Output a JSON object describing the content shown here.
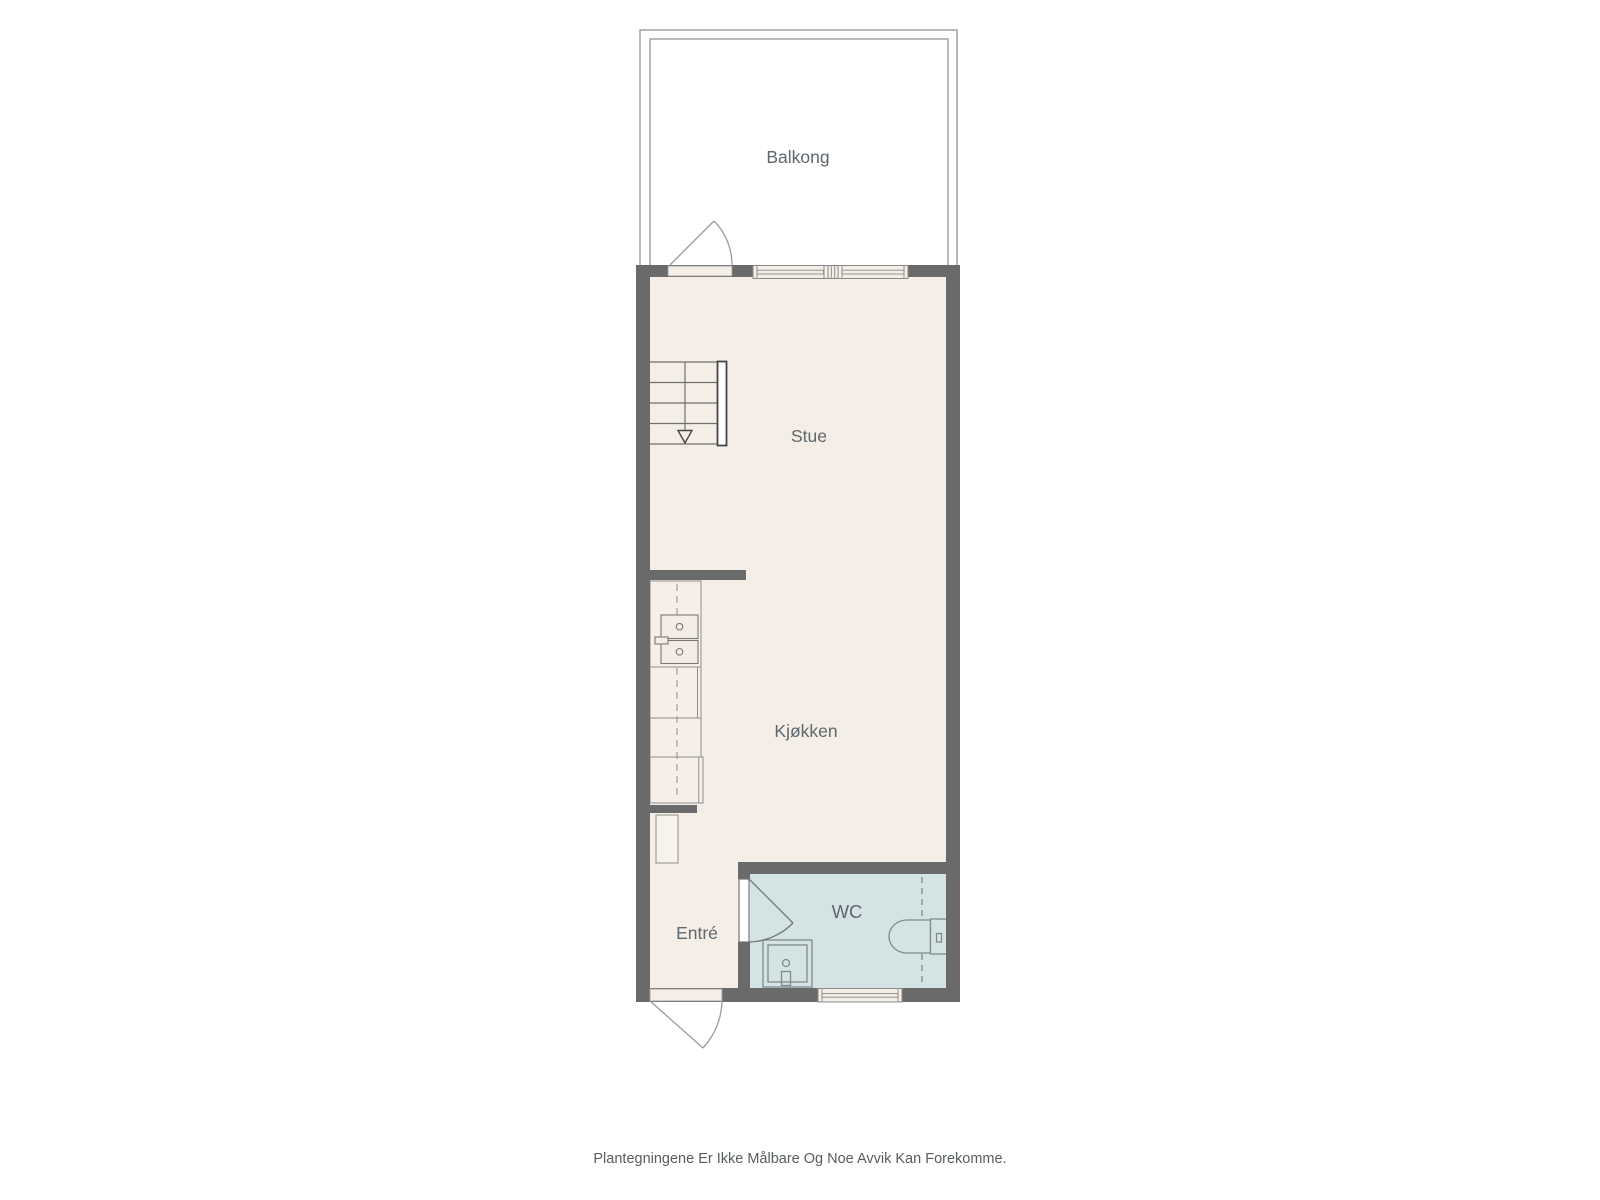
{
  "disclaimer": "Plantegningene Er Ikke Målbare Og Noe Avvik Kan Forekomme.",
  "rooms": [
    {
      "id": "balkong",
      "label": "Balkong"
    },
    {
      "id": "stue",
      "label": "Stue"
    },
    {
      "id": "kjokken",
      "label": "Kjøkken"
    },
    {
      "id": "entre",
      "label": "Entré"
    },
    {
      "id": "wc",
      "label": "WC"
    }
  ],
  "colors": {
    "background": "#ffffff",
    "wall": "#6a6a6a",
    "floor_main": "#f5eee7",
    "floor_wc": "#d4e3e4",
    "balcony_outline": "#9b9b9b",
    "window_frame": "#8a8a8a",
    "fixture_outline_wc": "#7f8a8c",
    "fixture_outline_kitchen": "#777777",
    "stair_detail": "#454545",
    "label_text": "#5e676c",
    "disclaimer_text": "#575d60"
  },
  "fixtures": {
    "staircase": "stairs-with-down-arrow",
    "kitchen": [
      "kitchen-counter",
      "double-bowl-sink",
      "sink-faucet",
      "appliance"
    ],
    "wc": [
      "shower",
      "toilet",
      "wet-zone-dashed-line"
    ],
    "doors": [
      "balcony-swing-door",
      "entrance-swing-door",
      "wc-swing-door"
    ],
    "windows": [
      "top-wall-double-window",
      "bottom-wall-window"
    ],
    "storage": [
      "entre-closet"
    ]
  }
}
